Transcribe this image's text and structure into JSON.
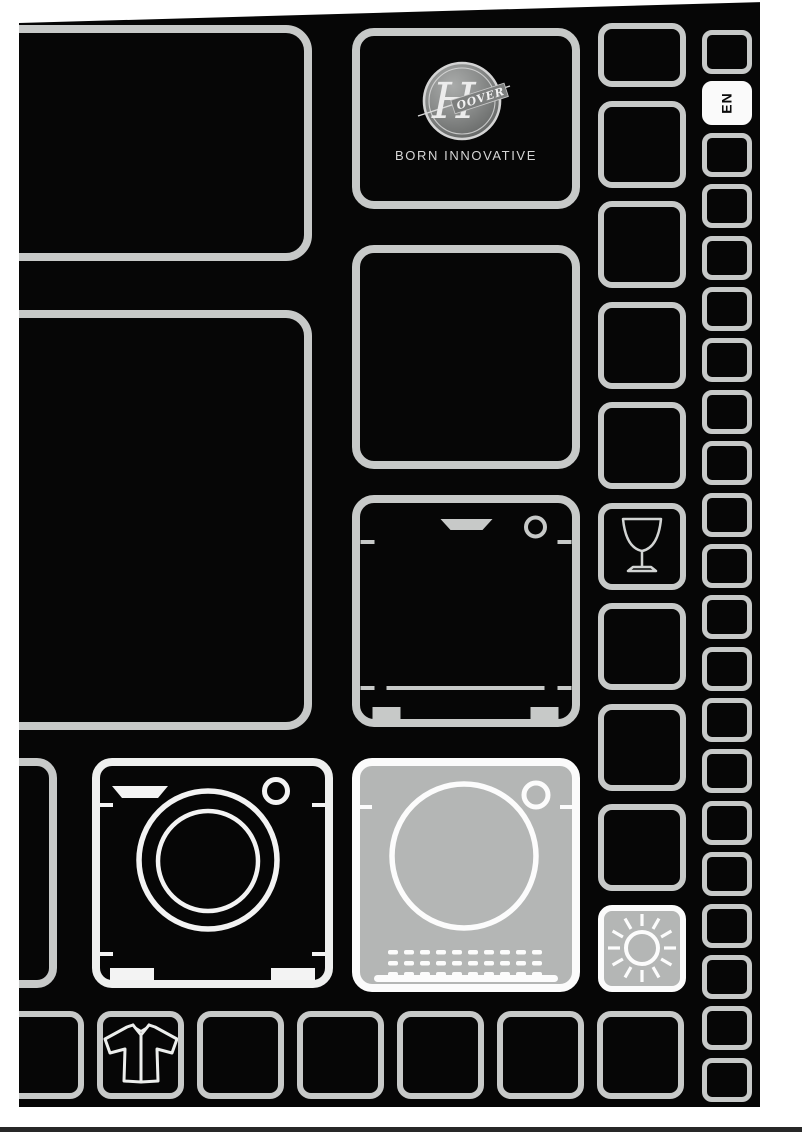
{
  "brand": {
    "initial": "H",
    "wordmark": "OOVER",
    "tagline": "BORN INNOVATIVE"
  },
  "language_badge": {
    "code": "EN"
  },
  "grid": {
    "columns": [
      {
        "container": "right-outer-column",
        "tile_count": 21,
        "special_tiles": {
          "1": "language-badge"
        }
      },
      {
        "container": "right-inner-column",
        "tile_count": 10,
        "special_tiles": {
          "5": "wine-glass",
          "9": "sun"
        }
      },
      {
        "container": "bottom-row",
        "tile_count": 7,
        "special_tiles": {
          "1": "shirt"
        }
      }
    ]
  },
  "icons": {
    "dishwasher": "dishwasher-icon",
    "washing_machine": "washing-machine-icon",
    "tumble_dryer": "tumble-dryer-icon",
    "wine_glass": "wine-glass-icon",
    "sun": "sun-icon",
    "shirt": "shirt-icon",
    "hoover_badge": "hoover-logo"
  },
  "colors": {
    "page_background": "#060606",
    "tile_border": "#c7c9c8",
    "appliance_highlight_border": "#eeefee",
    "filled_tile_background": "#b4b6b5",
    "filled_tile_border": "#fbfbfb",
    "language_tile_background": "#fafafa",
    "bottom_rule": "#282828"
  }
}
